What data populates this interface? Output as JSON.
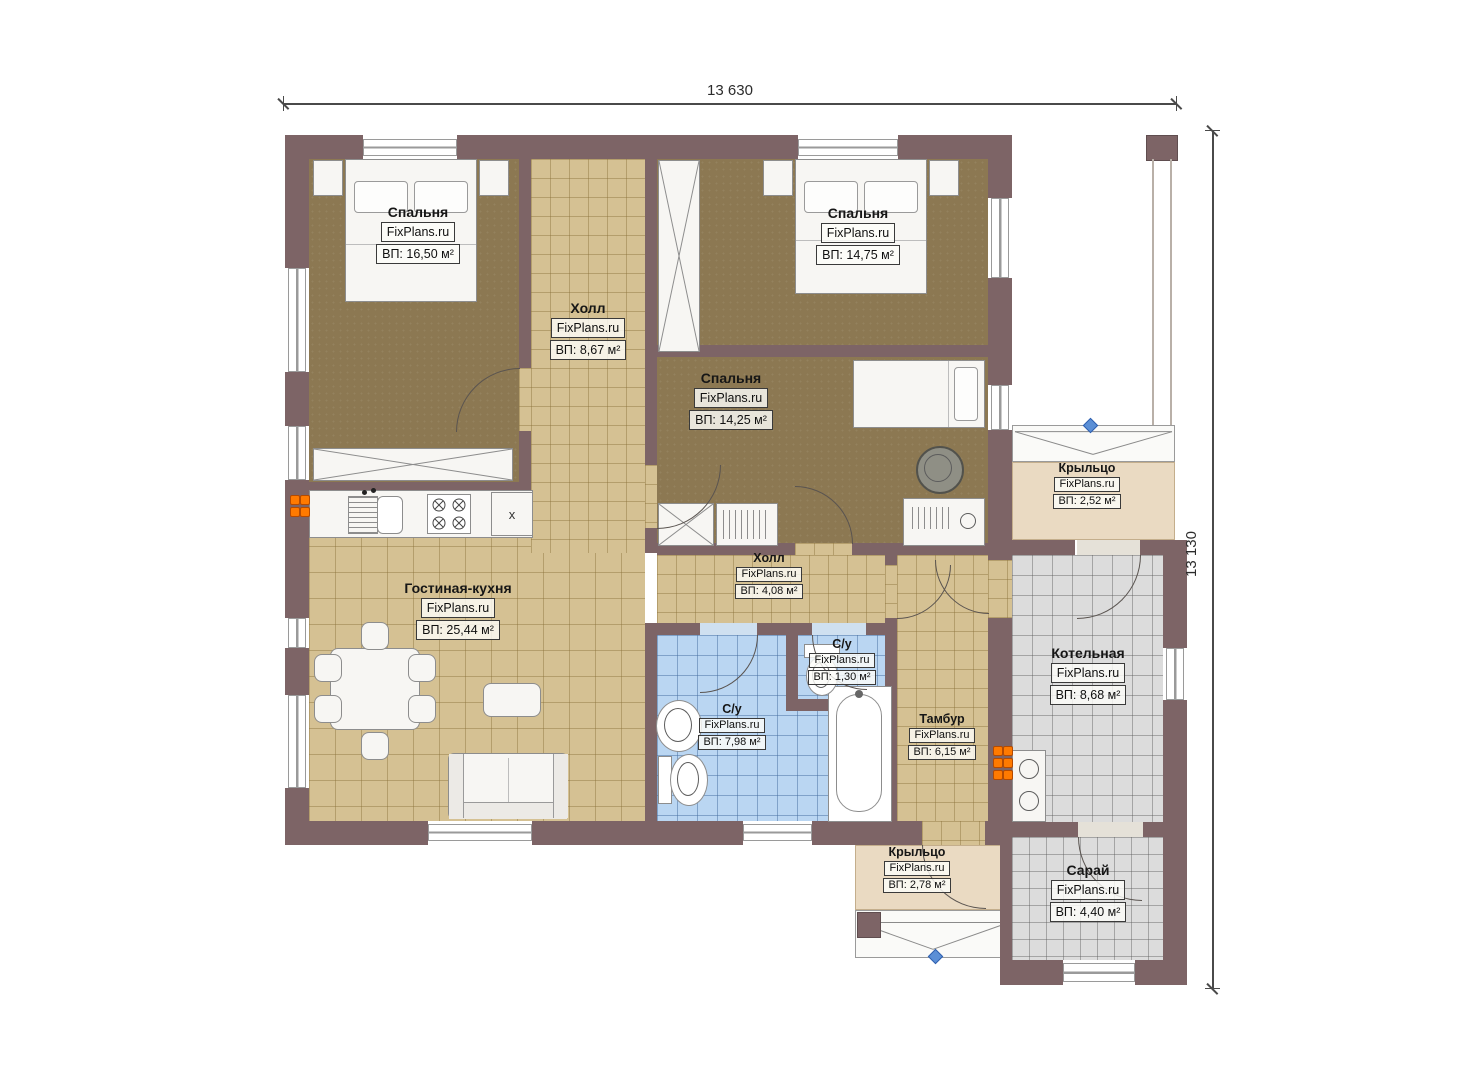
{
  "branding": {
    "watermark": "FixPlans.ru"
  },
  "dimensions": {
    "width_label": "13 630",
    "height_label": "13 130"
  },
  "rooms": [
    {
      "id": "bedroom-1",
      "name": "Спальня",
      "area": "ВП: 16,50 м²"
    },
    {
      "id": "hall-1",
      "name": "Холл",
      "area": "ВП: 8,67 м²"
    },
    {
      "id": "bedroom-2",
      "name": "Спальня",
      "area": "ВП: 14,75 м²"
    },
    {
      "id": "bedroom-3",
      "name": "Спальня",
      "area": "ВП: 14,25 м²"
    },
    {
      "id": "porch-1",
      "name": "Крыльцо",
      "area": "ВП: 2,52 м²"
    },
    {
      "id": "living",
      "name": "Гостиная-кухня",
      "area": "ВП: 25,44 м²"
    },
    {
      "id": "hall-2",
      "name": "Холл",
      "area": "ВП: 4,08 м²"
    },
    {
      "id": "wc-1",
      "name": "С/у",
      "area": "ВП: 1,30 м²"
    },
    {
      "id": "wc-2",
      "name": "С/у",
      "area": "ВП: 7,98 м²"
    },
    {
      "id": "tambour",
      "name": "Тамбур",
      "area": "ВП: 6,15 м²"
    },
    {
      "id": "boiler",
      "name": "Котельная",
      "area": "ВП: 8,68 м²"
    },
    {
      "id": "porch-2",
      "name": "Крыльцо",
      "area": "ВП: 2,78 м²"
    },
    {
      "id": "shed",
      "name": "Сарай",
      "area": "ВП: 4,40 м²"
    }
  ],
  "kitchen": {
    "unit_mark": "x"
  },
  "colors": {
    "wall": "#7D6466",
    "bedroom_floor": "#8C7852",
    "tile_floor": "#D5C193",
    "wet_floor": "#BAD6F2",
    "utility_floor": "#DCDCDC",
    "porch_floor": "#EADAC2",
    "radiator": "#FF7A00",
    "node_marker": "#5B8FD6"
  }
}
